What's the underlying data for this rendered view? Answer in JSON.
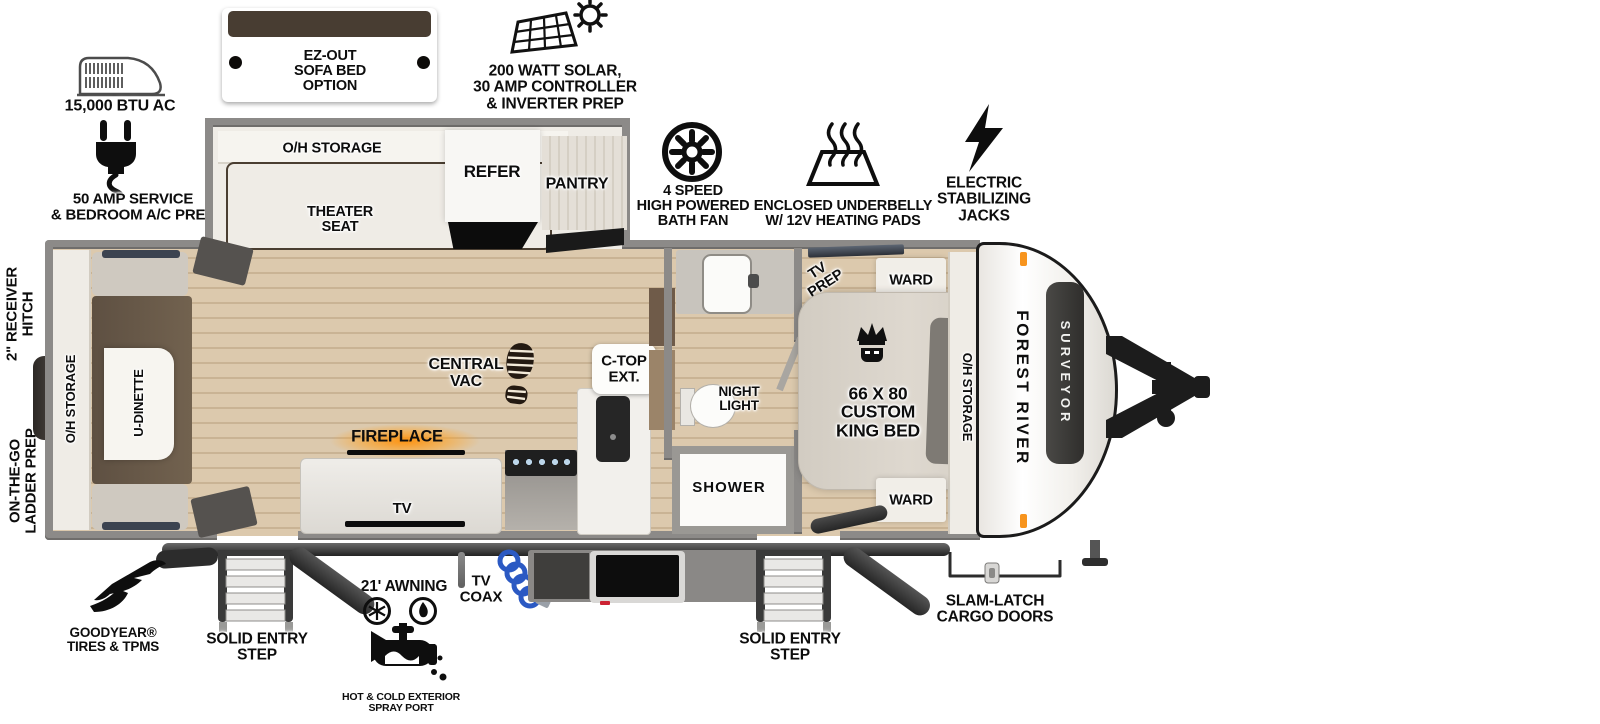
{
  "colors": {
    "accent_orange": "#f7941d",
    "floor_wood": "#dcc9ad",
    "wall_gray": "#8c8a88",
    "furniture_brown": "#6d5c4b",
    "awning_dark": "#2e2e2e",
    "coax_blue": "#2b59c3"
  },
  "callouts": {
    "ac": {
      "label": "15,000 BTU AC"
    },
    "sofa_option": {
      "label": "EZ-OUT\nSOFA BED\nOPTION"
    },
    "solar": {
      "label": "200 WATT SOLAR,\n30 AMP CONTROLLER\n& INVERTER PREP"
    },
    "service": {
      "label": "50 AMP SERVICE\n& BEDROOM A/C PREP"
    },
    "bath_fan": {
      "label": "4 SPEED\nHIGH POWERED\nBATH FAN"
    },
    "underbelly": {
      "label": "ENCLOSED UNDERBELLY\nW/ 12V HEATING PADS"
    },
    "jacks": {
      "label": "ELECTRIC\nSTABILIZING\nJACKS"
    },
    "receiver_hitch": {
      "label": "2\" RECEIVER\nHITCH"
    },
    "ladder_prep": {
      "label": "ON-THE-GO\nLADDER PREP"
    },
    "goodyear": {
      "label": "GOODYEAR®\nTIRES & TPMS"
    },
    "entry_step_1": {
      "label": "SOLID ENTRY\nSTEP"
    },
    "awning": {
      "label": "21' AWNING"
    },
    "spray_port": {
      "label": "HOT & COLD EXTERIOR\nSPRAY PORT"
    },
    "tv_coax": {
      "label": "TV\nCOAX"
    },
    "entry_step_2": {
      "label": "SOLID ENTRY\nSTEP"
    },
    "cargo_doors": {
      "label": "SLAM-LATCH\nCARGO DOORS"
    }
  },
  "rooms": {
    "slide": {
      "overhead": "O/H STORAGE",
      "theater": "THEATER\nSEAT"
    },
    "kitchen": {
      "refer": "REFER",
      "pantry": "PANTRY",
      "central_vac": "CENTRAL\nVAC",
      "countertop_ext": "C-TOP\nEXT.",
      "fireplace": "FIREPLACE",
      "tv": "TV"
    },
    "dinette": {
      "overhead": "O/H STORAGE",
      "udinette": "U-DINETTE"
    },
    "bath": {
      "night_light": "NIGHT\nLIGHT",
      "shower": "SHOWER"
    },
    "bedroom": {
      "tv_prep": "TV\nPREP",
      "ward_top": "WARD",
      "ward_bottom": "WARD",
      "bed": "66 X 80\nCUSTOM\nKING BED",
      "overhead": "O/H STORAGE"
    },
    "front_cap": {
      "brand": "FOREST RIVER",
      "model": "SURVEYOR"
    }
  }
}
